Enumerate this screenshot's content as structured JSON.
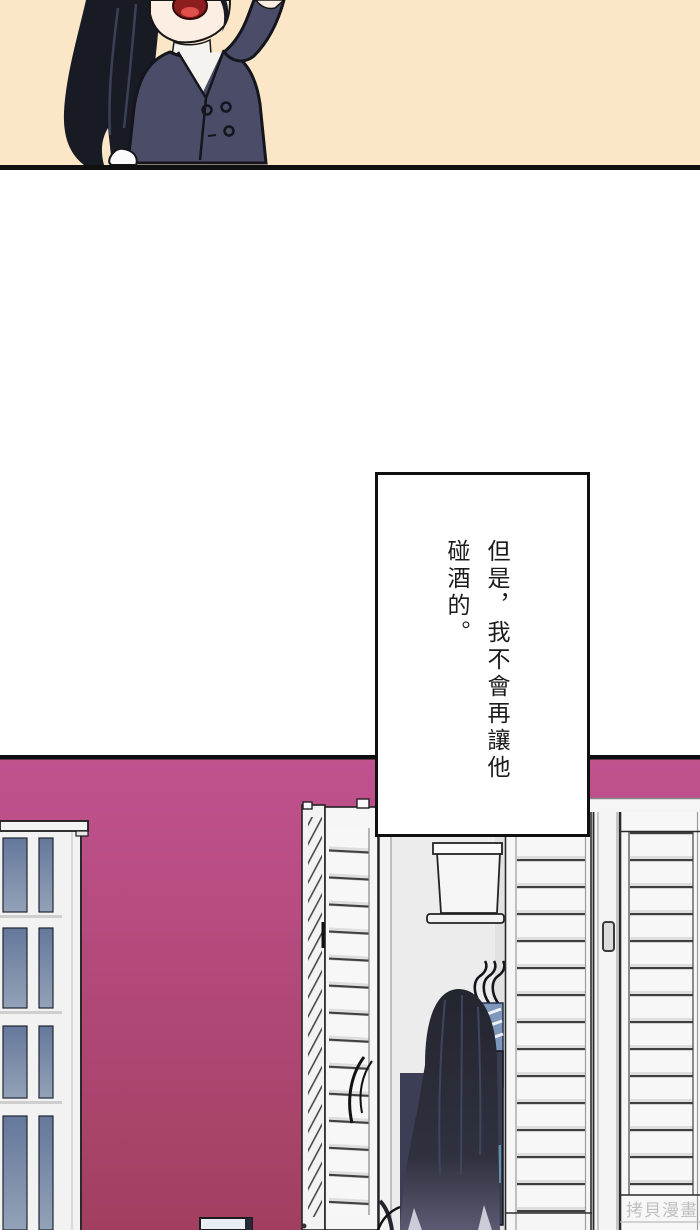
{
  "page": {
    "type": "comic-page",
    "alt_top_panel": "chibi character with long black hair in navy double-breasted coat, arm raised, open mouth, cream background",
    "alt_room_panel": "magenta-walled room with white louvered closet doors, one bifold door open showing shelf box, hangers with clothes and a long-haired character from behind; white shelf unit with blue glass panels at left"
  },
  "speech_box": {
    "line1": "但是，我不會再讓他",
    "line2": "碰酒的。"
  },
  "watermark": {
    "text": "拷貝漫畫"
  },
  "colors": {
    "top_panel_bg": "#fbe7c8",
    "panel_border": "#101010",
    "wall_top": "#c0528f",
    "wall_bottom": "#a23f60",
    "coat_navy": "#4b4c68",
    "hair_dark": "#1a1c26",
    "door_white": "#f6f6f6",
    "slat_line": "#3f3f3f",
    "glass_blue_top": "#64789b",
    "glass_blue_bottom": "#93a2b8",
    "closet_interior": "#ececec",
    "clothes_blue": "#7e97ba",
    "clothes_sage": "#aab9b1",
    "clothes_teal": "#5f93a8",
    "watermark_gray": "#b9b9b9"
  }
}
